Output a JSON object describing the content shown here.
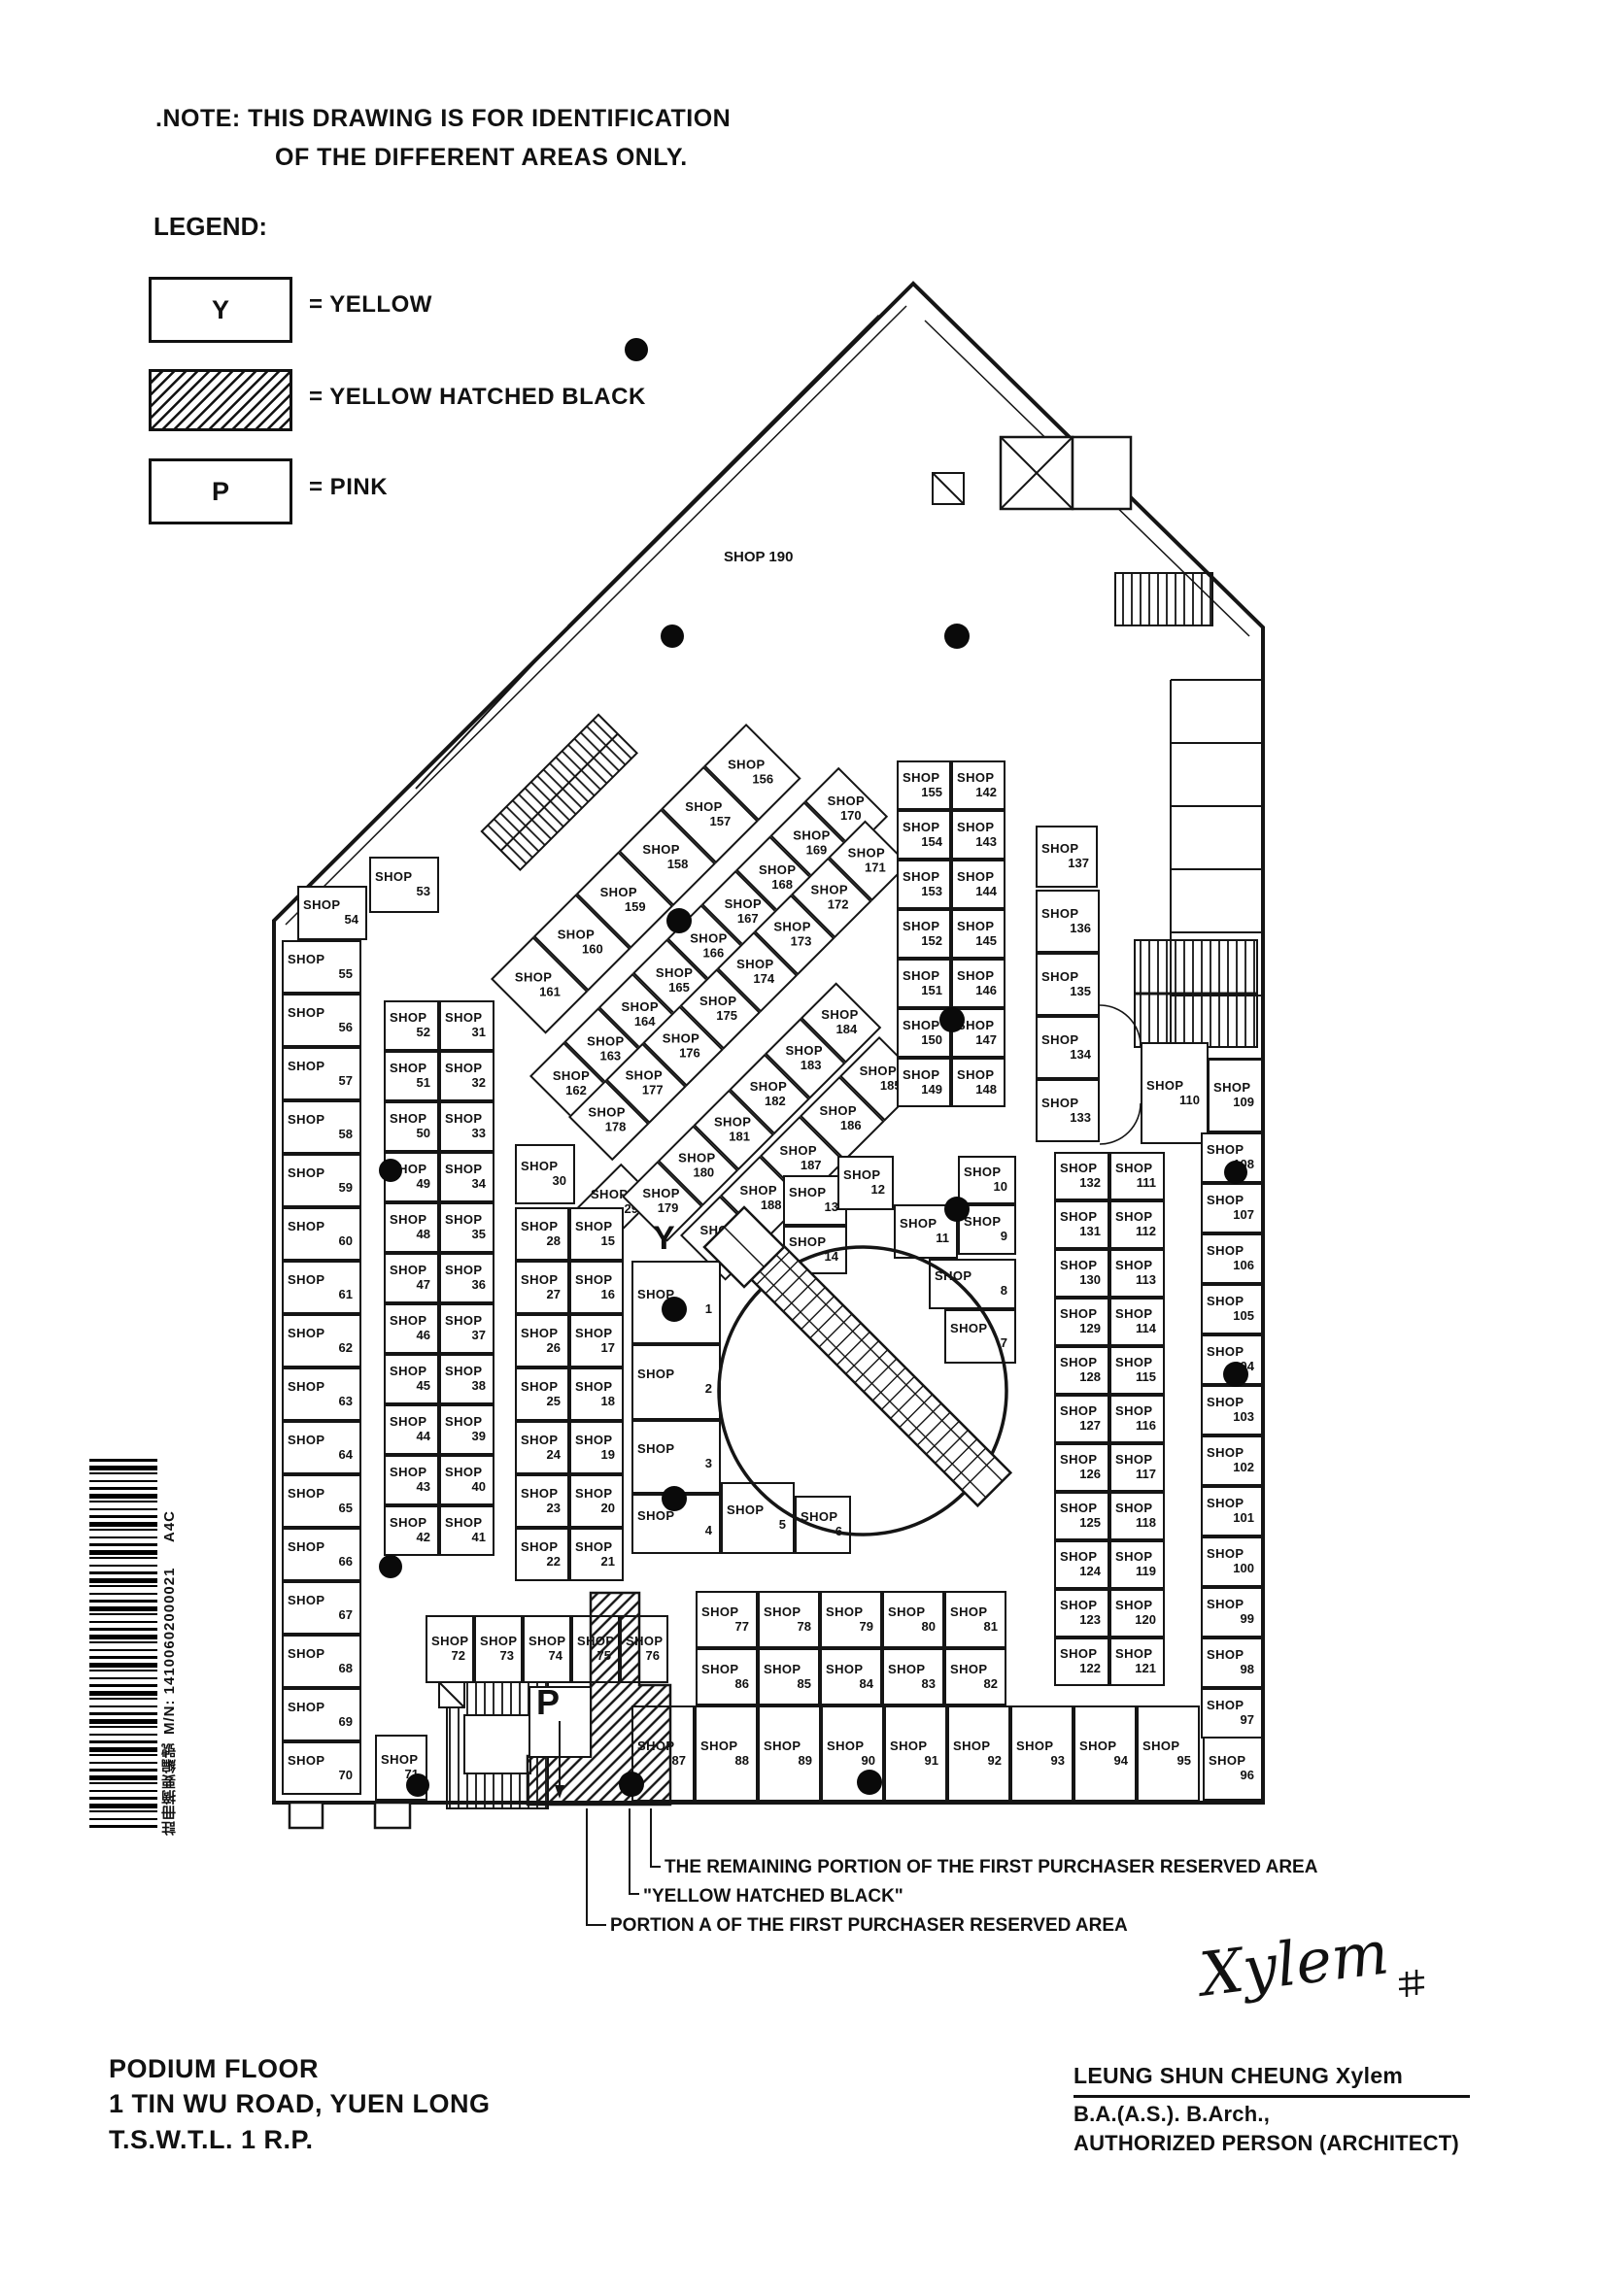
{
  "note": {
    "line1": ".NOTE:  THIS DRAWING IS FOR IDENTIFICATION",
    "line2": "OF THE DIFFERENT AREAS ONLY."
  },
  "legend": {
    "title": "LEGEND:",
    "items": [
      {
        "symbol": "Y",
        "label": "= YELLOW",
        "type": "plain"
      },
      {
        "symbol": "",
        "label": "= YELLOW  HATCHED  BLACK",
        "type": "hatched"
      },
      {
        "symbol": "P",
        "label": "= PINK",
        "type": "plain"
      }
    ]
  },
  "plan": {
    "shop_word": "SHOP",
    "labels": {
      "shop190": "SHOP  190",
      "y_marker": "Y",
      "p_marker": "P"
    },
    "shops": {
      "left_col": [
        "55",
        "56",
        "57",
        "58",
        "59",
        "60",
        "61",
        "62",
        "63",
        "64",
        "65",
        "66",
        "67",
        "68",
        "69",
        "70"
      ],
      "s53": [
        "53"
      ],
      "s54": [
        "54"
      ],
      "pair_b": [
        "52",
        "31",
        "51",
        "32",
        "50",
        "33",
        "49",
        "34",
        "48",
        "35",
        "47",
        "36",
        "46",
        "37",
        "45",
        "38",
        "44",
        "39",
        "43",
        "40",
        "42",
        "41"
      ],
      "s30": [
        "30"
      ],
      "s29": [
        "29"
      ],
      "pair_c": [
        "28",
        "15",
        "27",
        "16",
        "26",
        "17",
        "25",
        "18",
        "24",
        "19",
        "23",
        "20",
        "22",
        "21"
      ],
      "strip_a": [
        "161",
        "160",
        "159",
        "158",
        "157",
        "156"
      ],
      "strip_b": [
        "162",
        "163",
        "164",
        "165",
        "166",
        "167",
        "168",
        "169",
        "170"
      ],
      "strip_c": [
        "178",
        "177",
        "176",
        "175",
        "174",
        "173",
        "172",
        "171"
      ],
      "strip_d": [
        "179",
        "180",
        "181",
        "182",
        "183",
        "184"
      ],
      "strip_e": [
        "189",
        "188",
        "187",
        "186",
        "185"
      ],
      "mid_pair": [
        "155",
        "142",
        "154",
        "143",
        "153",
        "144",
        "152",
        "145",
        "151",
        "146",
        "150",
        "147",
        "149",
        "148"
      ],
      "s137": [
        "137"
      ],
      "col_136": [
        "136",
        "135",
        "134",
        "133"
      ],
      "s110": [
        "110"
      ],
      "s109": [
        "109"
      ],
      "pair_r": [
        "132",
        "111",
        "131",
        "112",
        "130",
        "113",
        "129",
        "114",
        "128",
        "115",
        "127",
        "116",
        "126",
        "117",
        "125",
        "118",
        "124",
        "119",
        "123",
        "120",
        "122",
        "121"
      ],
      "edge_col": [
        "108",
        "107",
        "106",
        "105",
        "104",
        "103",
        "102",
        "101",
        "100",
        "99",
        "98",
        "97"
      ],
      "s96": [
        "96"
      ],
      "bottom_row": [
        "87",
        "88",
        "89",
        "90",
        "91",
        "92",
        "93",
        "94",
        "95"
      ],
      "block_77": [
        "77",
        "78",
        "79",
        "80",
        "81",
        "86",
        "85",
        "84",
        "83",
        "82"
      ],
      "row_72": [
        "72",
        "73",
        "74",
        "75",
        "76"
      ],
      "s71": [
        "71"
      ],
      "s1": [
        "1"
      ],
      "s2": [
        "2"
      ],
      "s3": [
        "3"
      ],
      "s4": [
        "4"
      ],
      "s5": [
        "5"
      ],
      "s6": [
        "6"
      ],
      "s7": [
        "7"
      ],
      "s8": [
        "8"
      ],
      "s9": [
        "9"
      ],
      "s10": [
        "10"
      ],
      "s11": [
        "11"
      ],
      "s12": [
        "12"
      ],
      "s13": [
        "13"
      ],
      "s14": [
        "14"
      ]
    }
  },
  "annotations": {
    "line1": "THE REMAINING PORTION OF THE FIRST PURCHASER RESERVED AREA",
    "line2": "\"YELLOW HATCHED BLACK\"",
    "line3": "PORTION A OF THE FIRST PURCHASER RESERVED AREA"
  },
  "title_block": {
    "line1": "PODIUM FLOOR",
    "line2": "1 TIN WU ROAD, YUEN LONG",
    "line3": "T.S.W.T.L. 1 R.P."
  },
  "signature": {
    "script": "Xylem",
    "name": "LEUNG SHUN CHEUNG   Xylem",
    "qualification": "B.A.(A.S.). B.Arch.,",
    "role": "AUTHORIZED PERSON (ARCHITECT)"
  },
  "sidebar": {
    "cjk": "註冊摘要編號",
    "code": "M/N: 14100602000021",
    "suffix": "A4C"
  },
  "colors": {
    "ink": "#151515",
    "paper": "#ffffff"
  }
}
